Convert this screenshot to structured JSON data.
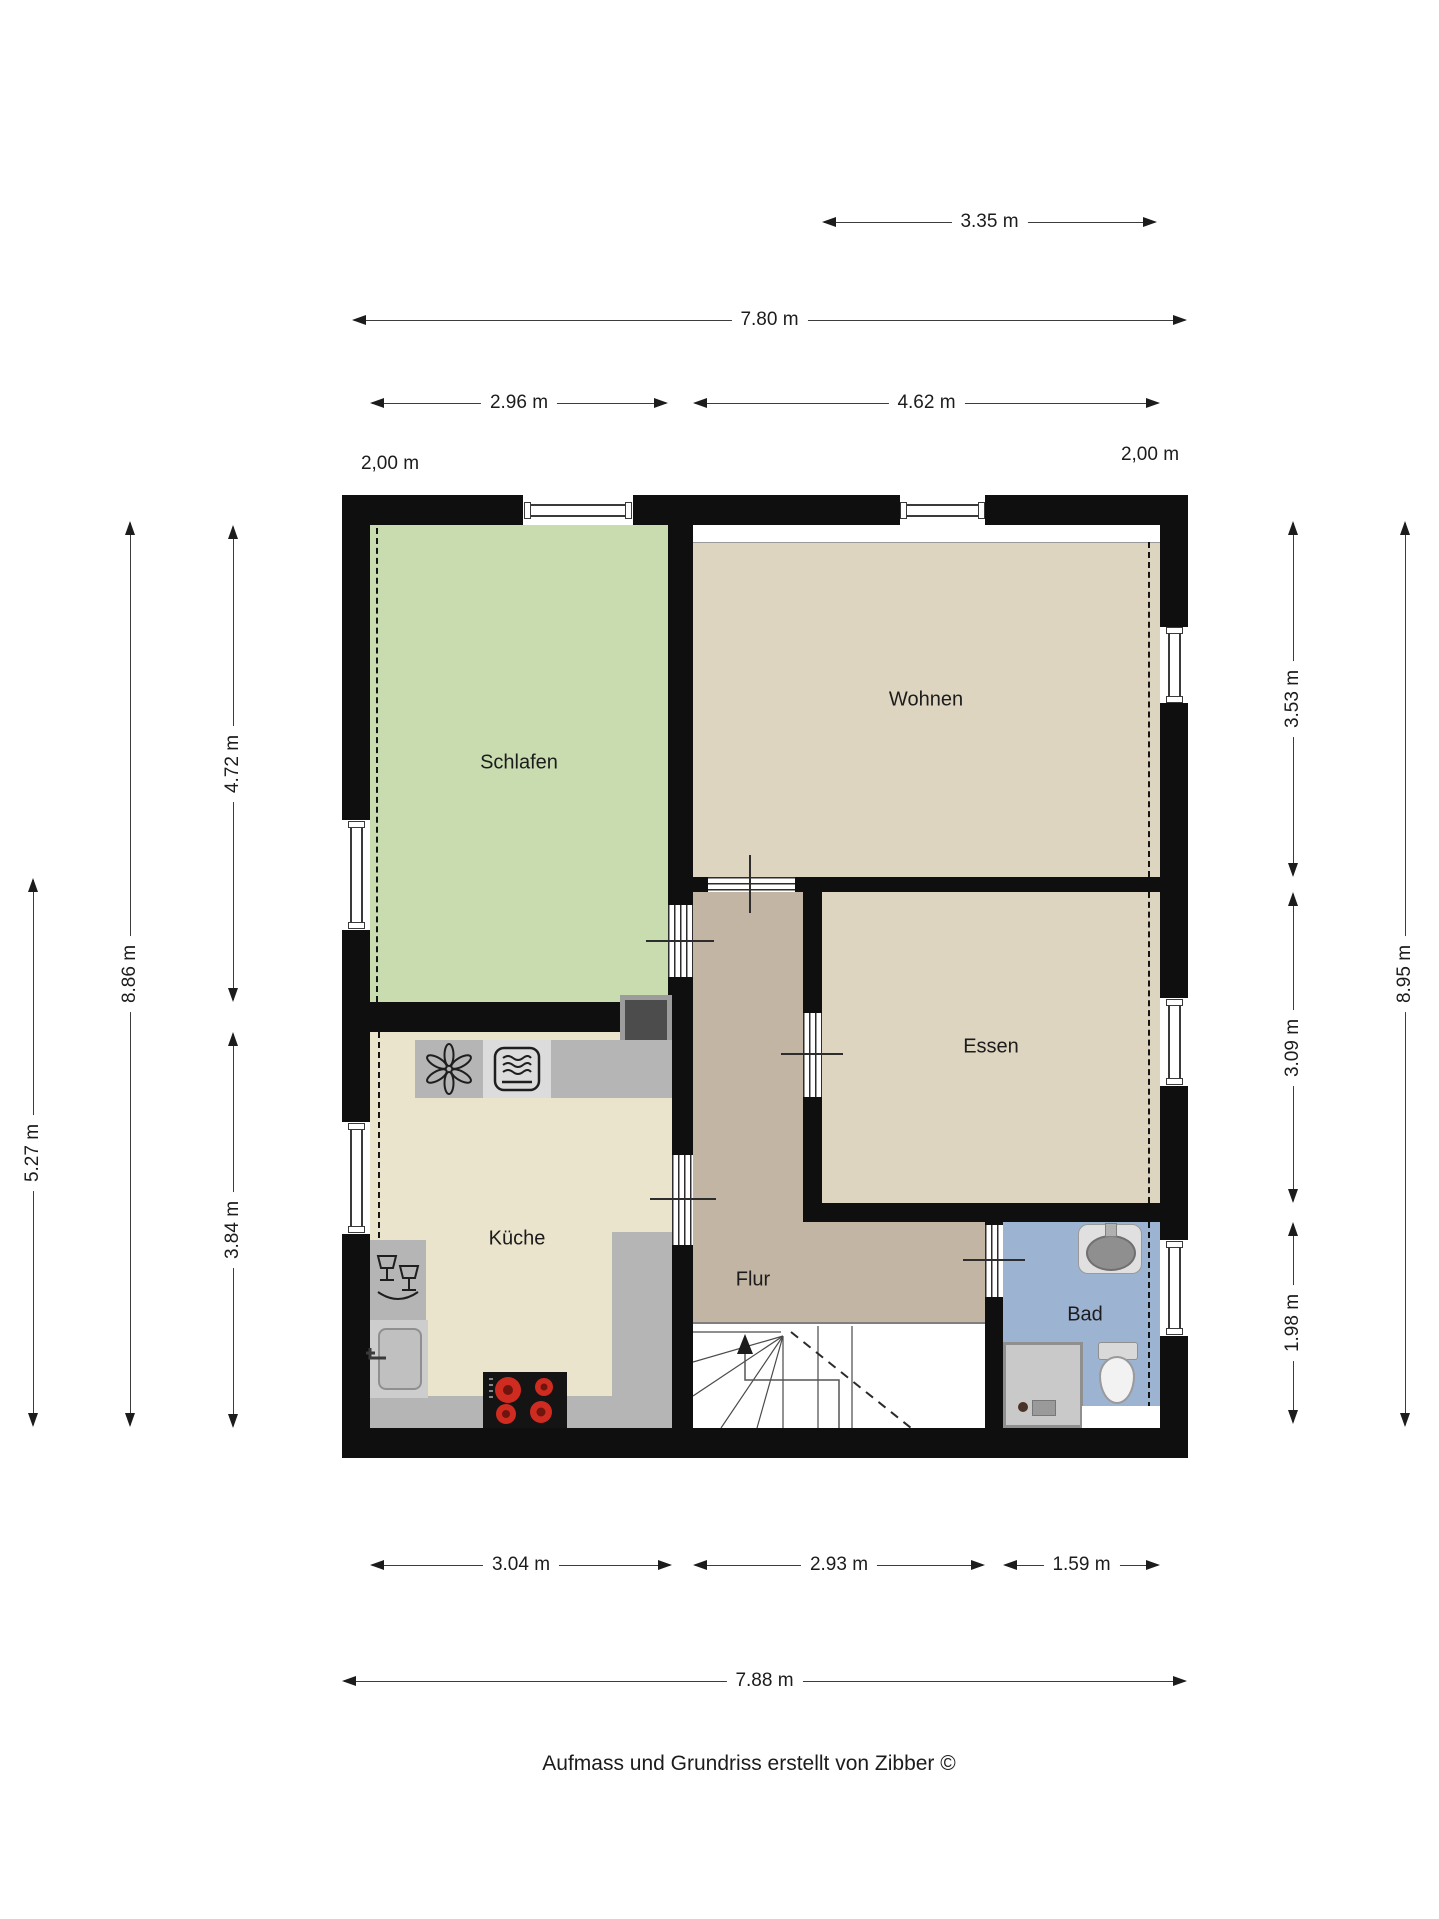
{
  "document": {
    "caption": "Aufmass und Grundriss erstellt von Zibber ©"
  },
  "plan": {
    "rooms": {
      "schlafen": {
        "label": "Schlafen",
        "color": "#c8dcb0"
      },
      "wohnen": {
        "label": "Wohnen",
        "color": "#ddd5c0"
      },
      "essen": {
        "label": "Essen",
        "color": "#ddd5c0"
      },
      "kueche": {
        "label": "Küche",
        "color": "#ebe4cd"
      },
      "flur": {
        "label": "Flur",
        "color": "#c3b5a4"
      },
      "bad": {
        "label": "Bad",
        "color": "#9db3d2"
      }
    },
    "knee_wall_labels": {
      "left": "2,00 m",
      "right": "2,00 m"
    },
    "icons": [
      "extractor-fan-icon",
      "oven-icon",
      "dishwasher-icon",
      "kitchen-sink-icon",
      "hob-icon",
      "washbasin-icon",
      "toilet-icon",
      "shower-icon",
      "stairs-up-arrow-icon",
      "chimney-block"
    ]
  },
  "dimensions": {
    "top": [
      {
        "id": "essen-width-top",
        "label": "3.35 m"
      },
      {
        "id": "overall-width-top",
        "label": "7.80 m"
      },
      {
        "id": "schlafen-width",
        "label": "2.96 m"
      },
      {
        "id": "wohnen-width",
        "label": "4.62 m"
      }
    ],
    "bottom": [
      {
        "id": "kueche-width",
        "label": "3.04 m"
      },
      {
        "id": "flur-width",
        "label": "2.93 m"
      },
      {
        "id": "bad-width",
        "label": "1.59 m"
      },
      {
        "id": "overall-width-bottom",
        "label": "7.88 m"
      }
    ],
    "left": [
      {
        "id": "schlafen-height",
        "label": "4.72 m"
      },
      {
        "id": "kueche-height",
        "label": "3.84 m"
      },
      {
        "id": "overall-height-left",
        "label": "8.86 m"
      },
      {
        "id": "lower-part-height",
        "label": "5.27 m"
      }
    ],
    "right": [
      {
        "id": "wohnen-height",
        "label": "3.53 m"
      },
      {
        "id": "essen-height",
        "label": "3.09 m"
      },
      {
        "id": "bad-height",
        "label": "1.98 m"
      },
      {
        "id": "overall-height-right",
        "label": "8.95 m"
      }
    ]
  },
  "colors": {
    "wall": "#0f0f0f",
    "dimension_line": "#3c3c3c",
    "counter": "#b5b5b5",
    "stove": "#141414",
    "burner": "#cf2b20",
    "shower": "#c9c9c9",
    "chimney": "#4c4c4c",
    "bad_blue": "#9db3d2",
    "schlafen_green": "#c8dcb0",
    "flur_brown": "#c3b5a4"
  }
}
